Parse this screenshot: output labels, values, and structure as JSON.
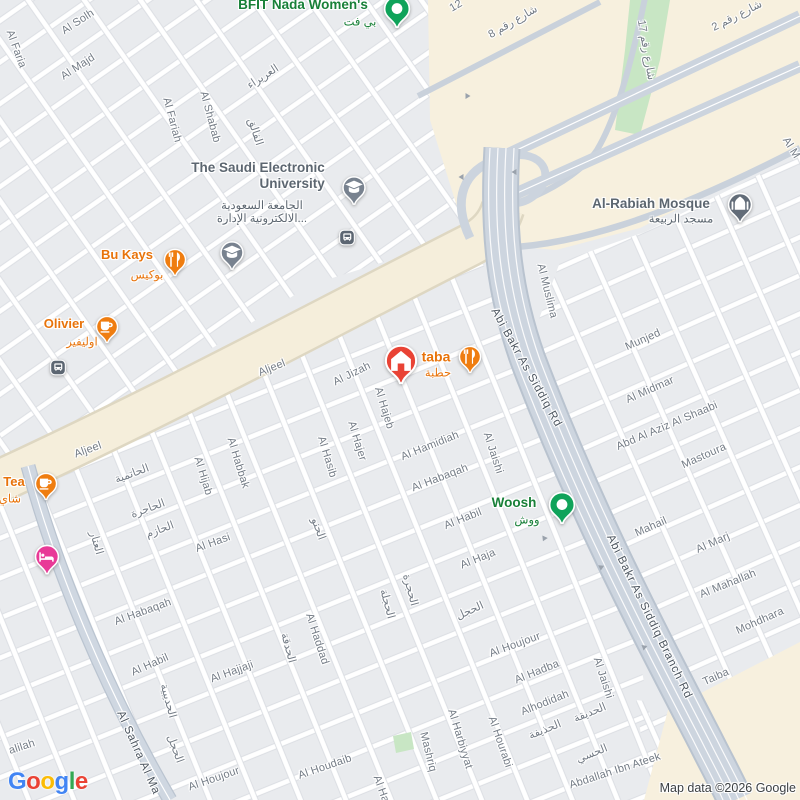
{
  "attribution": "Map data ©2026 Google",
  "logo": {
    "text": "Google",
    "letters": [
      {
        "ch": "G",
        "color": "#4285F4"
      },
      {
        "ch": "o",
        "color": "#EA4335"
      },
      {
        "ch": "o",
        "color": "#FBBC05"
      },
      {
        "ch": "g",
        "color": "#4285F4"
      },
      {
        "ch": "l",
        "color": "#34A853"
      },
      {
        "ch": "e",
        "color": "#EA4335"
      }
    ]
  },
  "colors": {
    "map_bg": "#e9ebee",
    "road_minor": "#ffffff",
    "road_major": "#cdd5df",
    "road_arterial": "#f5eedb",
    "commercial_area": "#f7f0de",
    "park": "#c8e6c4",
    "label_minor": "#747c86",
    "label_road": "#4c555f",
    "poi_food": "#e8730a",
    "poi_green": "#188038",
    "poi_civic": "#5c6670",
    "marker_orange": "#ef7d10",
    "marker_green": "#10a35a",
    "marker_red": "#e94335",
    "marker_pink": "#e83a97",
    "marker_slate": "#78828f",
    "marker_dark": "#626c78"
  },
  "street_labels": [
    {
      "t": "Al Solh",
      "x": 78,
      "y": 22,
      "r": -33
    },
    {
      "t": "Al Majd",
      "x": 78,
      "y": 67,
      "r": -33
    },
    {
      "t": "Al Faria",
      "x": 16,
      "y": 49,
      "r": 70
    },
    {
      "t": "Al Fariah",
      "x": 172,
      "y": 120,
      "r": 75
    },
    {
      "t": "Al Shabab",
      "x": 210,
      "y": 117,
      "r": 75
    },
    {
      "t": "العريراء",
      "x": 263,
      "y": 77,
      "r": -33
    },
    {
      "t": "الفالق",
      "x": 255,
      "y": 132,
      "r": 72
    },
    {
      "t": "شارع رقم 8",
      "x": 513,
      "y": 22,
      "r": -30
    },
    {
      "t": "12",
      "x": 456,
      "y": 6,
      "r": -30
    },
    {
      "t": "شارع رقم 17",
      "x": 646,
      "y": 50,
      "r": 80
    },
    {
      "t": "شارع رقم 2",
      "x": 737,
      "y": 16,
      "r": -27
    },
    {
      "t": "Al M",
      "x": 791,
      "y": 148,
      "r": 58
    },
    {
      "t": "Abi Bakr As Siddiq Rd",
      "x": 526,
      "y": 368,
      "r": 61,
      "k": "road"
    },
    {
      "t": "Abi Bakr As Siddiq Branch Rd",
      "x": 649,
      "y": 617,
      "r": 64,
      "k": "road"
    },
    {
      "t": "Al Sahra Al Ma",
      "x": 138,
      "y": 753,
      "r": 66,
      "k": "road"
    },
    {
      "t": "Al Muslima",
      "x": 547,
      "y": 291,
      "r": 76
    },
    {
      "t": "Munjed",
      "x": 643,
      "y": 340,
      "r": -24
    },
    {
      "t": "Al Midmar",
      "x": 650,
      "y": 390,
      "r": -24
    },
    {
      "t": "Abd Al Aziz Al Shaabi",
      "x": 667,
      "y": 426,
      "r": -23
    },
    {
      "t": "Mastoura",
      "x": 704,
      "y": 456,
      "r": -24
    },
    {
      "t": "Mahail",
      "x": 651,
      "y": 527,
      "r": -24
    },
    {
      "t": "Al Marj",
      "x": 713,
      "y": 543,
      "r": -24
    },
    {
      "t": "Al Mahallah",
      "x": 728,
      "y": 584,
      "r": -22
    },
    {
      "t": "Mohdhara",
      "x": 760,
      "y": 621,
      "r": -24
    },
    {
      "t": "Taiba",
      "x": 716,
      "y": 677,
      "r": -24
    },
    {
      "t": "Al Jaishi",
      "x": 603,
      "y": 678,
      "r": 72
    },
    {
      "t": "Abdallah Ibn Ateek",
      "x": 615,
      "y": 771,
      "r": -18
    },
    {
      "t": "Alhodidah",
      "x": 545,
      "y": 703,
      "r": -22
    },
    {
      "t": "الحديقة",
      "x": 590,
      "y": 713,
      "r": -22
    },
    {
      "t": "الحذيفة",
      "x": 545,
      "y": 730,
      "r": -22
    },
    {
      "t": "الحسي",
      "x": 592,
      "y": 754,
      "r": -22
    },
    {
      "t": "Aljeel",
      "x": 272,
      "y": 368,
      "r": -22
    },
    {
      "t": "Aljeel",
      "x": 88,
      "y": 450,
      "r": -20
    },
    {
      "t": "Al Jizah",
      "x": 352,
      "y": 374,
      "r": -26
    },
    {
      "t": "Al Hajeb",
      "x": 384,
      "y": 408,
      "r": 73
    },
    {
      "t": "Al Hajer",
      "x": 357,
      "y": 441,
      "r": 73
    },
    {
      "t": "Al Hasib",
      "x": 327,
      "y": 457,
      "r": 73
    },
    {
      "t": "Al Habbak",
      "x": 238,
      "y": 463,
      "r": 73
    },
    {
      "t": "Al Hijab",
      "x": 203,
      "y": 476,
      "r": 73
    },
    {
      "t": "الحاتمية",
      "x": 132,
      "y": 474,
      "r": -20
    },
    {
      "t": "الحاجرة",
      "x": 148,
      "y": 509,
      "r": -20
    },
    {
      "t": "الحازم",
      "x": 160,
      "y": 530,
      "r": -20
    },
    {
      "t": "العتار",
      "x": 96,
      "y": 543,
      "r": 74
    },
    {
      "t": "Al Hasi",
      "x": 213,
      "y": 543,
      "r": -20
    },
    {
      "t": "Al Hamidiah",
      "x": 430,
      "y": 446,
      "r": -22
    },
    {
      "t": "Al Jaishi",
      "x": 493,
      "y": 453,
      "r": 72
    },
    {
      "t": "Al Habaqah",
      "x": 440,
      "y": 478,
      "r": -21
    },
    {
      "t": "Al Habil",
      "x": 463,
      "y": 519,
      "r": -22
    },
    {
      "t": "Al Haja",
      "x": 478,
      "y": 559,
      "r": -22
    },
    {
      "t": "الحجل",
      "x": 470,
      "y": 611,
      "r": -24
    },
    {
      "t": "الحجرة",
      "x": 410,
      "y": 590,
      "r": 75
    },
    {
      "t": "الحجلة",
      "x": 387,
      "y": 604,
      "r": 75
    },
    {
      "t": "الحنو",
      "x": 318,
      "y": 529,
      "r": 70
    },
    {
      "t": "Al Habaqah",
      "x": 143,
      "y": 612,
      "r": -20
    },
    {
      "t": "Al Habil",
      "x": 150,
      "y": 665,
      "r": -24
    },
    {
      "t": "Al Hajjaji",
      "x": 232,
      "y": 672,
      "r": -20
    },
    {
      "t": "Al Haddad",
      "x": 317,
      "y": 639,
      "r": 72
    },
    {
      "t": "الحدقة",
      "x": 288,
      "y": 648,
      "r": 75
    },
    {
      "t": "الحديبية",
      "x": 168,
      "y": 701,
      "r": 75
    },
    {
      "t": "الحجل",
      "x": 175,
      "y": 749,
      "r": 70
    },
    {
      "t": "Al Houjour",
      "x": 515,
      "y": 645,
      "r": -20
    },
    {
      "t": "Al Houjour",
      "x": 214,
      "y": 779,
      "r": -19
    },
    {
      "t": "Al Houdaib",
      "x": 325,
      "y": 767,
      "r": -19
    },
    {
      "t": "Mashriq",
      "x": 428,
      "y": 752,
      "r": 76
    },
    {
      "t": "Al Harbiyyat",
      "x": 460,
      "y": 739,
      "r": 73
    },
    {
      "t": "Al Hourabi",
      "x": 500,
      "y": 742,
      "r": 71
    },
    {
      "t": "Al Hadba",
      "x": 537,
      "y": 672,
      "r": -22
    },
    {
      "t": "alilah",
      "x": 22,
      "y": 747,
      "r": -18
    },
    {
      "t": "Al Ha",
      "x": 381,
      "y": 789,
      "r": 70
    }
  ],
  "arrows": [
    {
      "x": 468,
      "y": 96,
      "r": 0
    },
    {
      "x": 461,
      "y": 177,
      "r": 180
    },
    {
      "x": 514,
      "y": 172,
      "r": 180
    },
    {
      "x": 544,
      "y": 539,
      "r": 115
    },
    {
      "x": 601,
      "y": 568,
      "r": 95
    },
    {
      "x": 644,
      "y": 648,
      "r": 100
    }
  ],
  "pois": [
    {
      "slug": "bfit-nada-womens",
      "label": {
        "lines": [
          "BFIT Nada Women's"
        ],
        "x": 303,
        "y": 5,
        "c": "green",
        "fs": 13.5
      },
      "ar": {
        "lines": [
          "بي فت"
        ],
        "x": 360,
        "y": 23,
        "c": "green"
      },
      "marker": {
        "x": 397,
        "y": 11,
        "icon": "dot",
        "fill": "#10a35a",
        "w": 27
      }
    },
    {
      "slug": "saudi-electronic-university",
      "label": {
        "lines": [
          "The Saudi Electronic",
          "University"
        ],
        "x": 258,
        "y": 176,
        "c": "civic",
        "fs": 13.5,
        "align": "right"
      },
      "ar": {
        "lines": [
          "الجامعة السعودية",
          "الالكترونية الإدارة..."
        ],
        "x": 262,
        "y": 213,
        "c": "civic"
      },
      "marker": {
        "x": 354,
        "y": 190,
        "icon": "grad",
        "fill": "#78828f",
        "w": 24
      }
    },
    {
      "slug": "saudi-electronic-university-2",
      "marker": {
        "x": 232,
        "y": 255,
        "icon": "grad",
        "fill": "#78828f",
        "w": 24
      }
    },
    {
      "slug": "bu-kays",
      "label": {
        "lines": [
          "Bu Kays"
        ],
        "x": 127,
        "y": 255,
        "c": "food"
      },
      "ar": {
        "lines": [
          "بوكيس"
        ],
        "x": 147,
        "y": 276,
        "c": "food"
      },
      "marker": {
        "x": 175,
        "y": 262,
        "icon": "utensils",
        "fill": "#ef7d10",
        "w": 23
      }
    },
    {
      "slug": "olivier",
      "label": {
        "lines": [
          "Olivier"
        ],
        "x": 64,
        "y": 324,
        "c": "food"
      },
      "ar": {
        "lines": [
          "اوليفير"
        ],
        "x": 82,
        "y": 343,
        "c": "food"
      },
      "marker": {
        "x": 107,
        "y": 329,
        "icon": "cup",
        "fill": "#ef7d10",
        "w": 23
      }
    },
    {
      "slug": "tea",
      "label": {
        "lines": [
          "Tea"
        ],
        "x": 14,
        "y": 482,
        "c": "food"
      },
      "ar": {
        "lines": [
          "شاي"
        ],
        "x": 10,
        "y": 500,
        "c": "food"
      },
      "marker": {
        "x": 46,
        "y": 486,
        "icon": "cup",
        "fill": "#ef7d10",
        "w": 23
      }
    },
    {
      "slug": "taba",
      "label": {
        "lines": [
          "taba"
        ],
        "x": 436,
        "y": 357,
        "c": "food",
        "fs": 14
      },
      "ar": {
        "lines": [
          "حطبة"
        ],
        "x": 438,
        "y": 374,
        "c": "food"
      },
      "marker": {
        "x": 470,
        "y": 359,
        "icon": "utensils",
        "fill": "#ef7d10",
        "w": 23
      }
    },
    {
      "slug": "woosh",
      "label": {
        "lines": [
          "Woosh"
        ],
        "x": 514,
        "y": 503,
        "c": "green",
        "fs": 13.5
      },
      "ar": {
        "lines": [
          "ووش"
        ],
        "x": 527,
        "y": 521,
        "c": "green"
      },
      "marker": {
        "x": 562,
        "y": 507,
        "icon": "dot",
        "fill": "#10a35a",
        "w": 27
      }
    },
    {
      "slug": "al-rabiah-mosque",
      "label": {
        "lines": [
          "Al-Rabiah Mosque"
        ],
        "x": 651,
        "y": 204,
        "c": "civic",
        "fs": 13.5
      },
      "ar": {
        "lines": [
          "مسجد الربيعة"
        ],
        "x": 681,
        "y": 220,
        "c": "civic"
      },
      "marker": {
        "x": 740,
        "y": 207,
        "icon": "mosque",
        "fill": "#626c78",
        "w": 25
      }
    },
    {
      "slug": "home",
      "marker": {
        "x": 401,
        "y": 363,
        "icon": "home",
        "fill": "#e94335",
        "w": 33
      }
    },
    {
      "slug": "hotel",
      "marker": {
        "x": 47,
        "y": 559,
        "icon": "bed",
        "fill": "#e83a97",
        "w": 25
      }
    },
    {
      "slug": "bus-station-1",
      "marker": {
        "x": 347,
        "y": 240,
        "icon": "bus",
        "fill": "#5c6672",
        "w": 16,
        "shape": "badge"
      }
    },
    {
      "slug": "bus-station-2",
      "marker": {
        "x": 58,
        "y": 370,
        "icon": "bus",
        "fill": "#5c6672",
        "w": 16,
        "shape": "badge"
      }
    }
  ]
}
